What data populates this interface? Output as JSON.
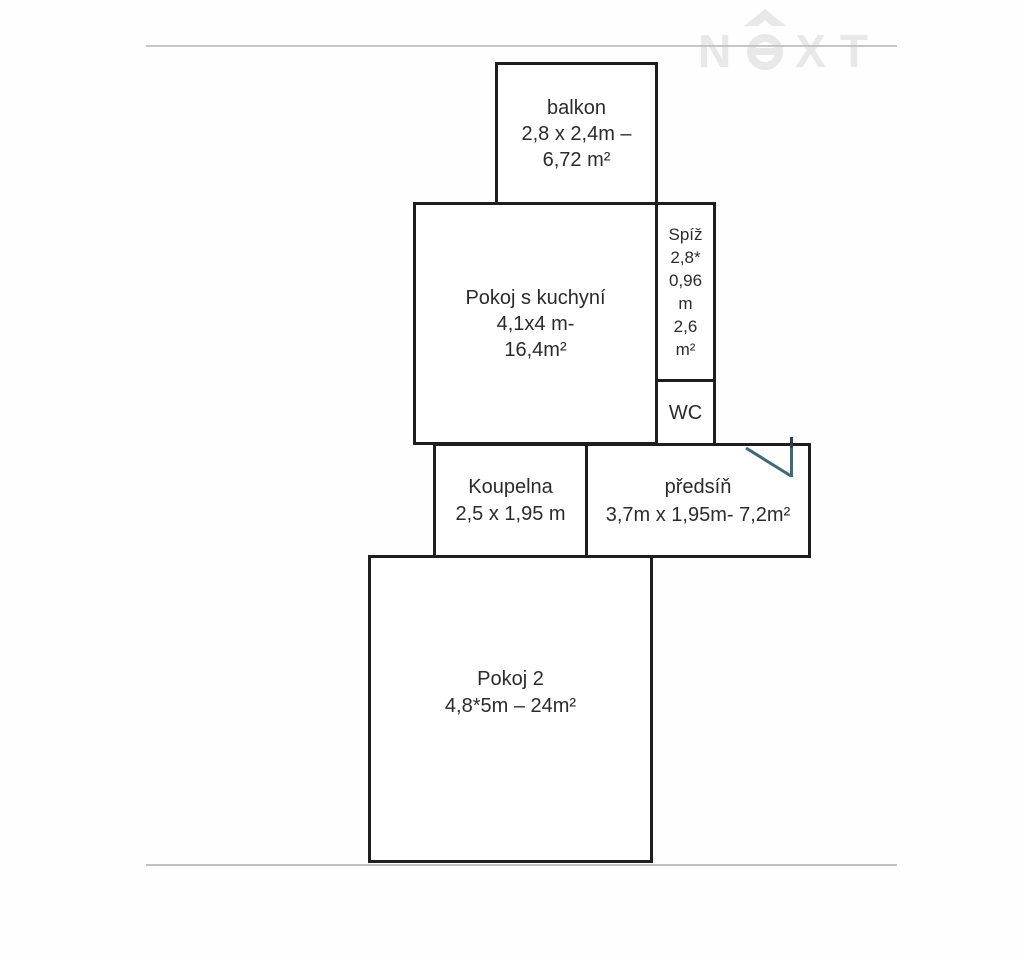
{
  "watermark": {
    "letter_n": "N",
    "letters_xt": "XT",
    "house_icon": "roof-over-circle-e"
  },
  "rooms": {
    "balkon": {
      "lines": [
        "balkon",
        "2,8 x 2,4m –",
        "6,72 m²"
      ]
    },
    "pokoj_s_kuchyni": {
      "lines": [
        "Pokoj s kuchyní",
        "4,1x4 m-",
        "16,4m²"
      ]
    },
    "spiz": {
      "lines": [
        "Spíž",
        "2,8*",
        "0,96",
        "m",
        "2,6",
        "m²"
      ]
    },
    "wc": {
      "lines": [
        "WC"
      ]
    },
    "koupelna": {
      "lines": [
        "Koupelna",
        "2,5 x 1,95 m"
      ]
    },
    "predsin": {
      "lines": [
        "předsíň",
        "3,7m x 1,95m- 7,2m²"
      ]
    },
    "pokoj2": {
      "lines": [
        "Pokoj 2",
        "4,8*5m – 24m²"
      ]
    }
  },
  "colors": {
    "wall": "#1e1e1e",
    "door_swing": "#3c6b7c",
    "door_jamb": "#27434c",
    "watermark": "#e8e8e8",
    "frame_line": "#c0c0c0",
    "text": "#2b2b2b",
    "background": "#fefefe"
  }
}
